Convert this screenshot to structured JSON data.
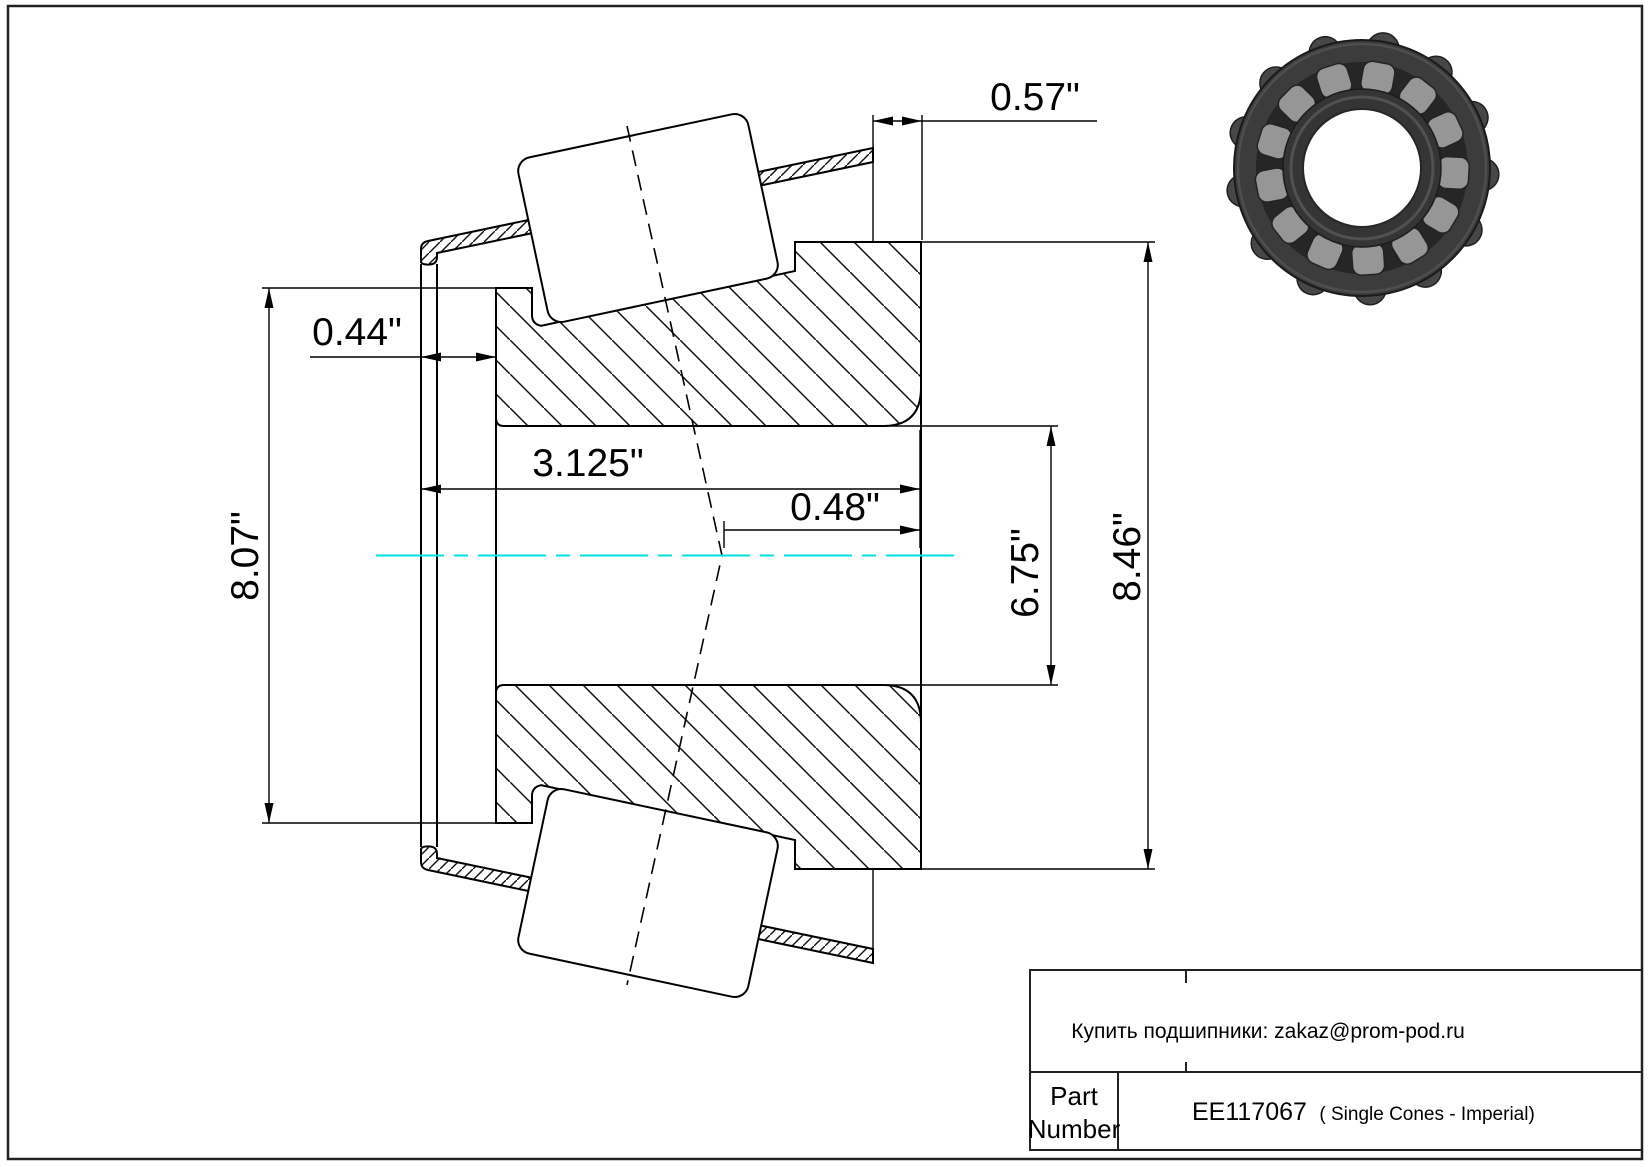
{
  "page": {
    "background": "#ffffff",
    "line_color": "#000000",
    "centerline_color": "#00e0e0",
    "bearing_photo_colors": {
      "body": "#3c3c3c",
      "rollers": "#969696",
      "inner_ring": "#353535",
      "outline": "#1a1a1a"
    }
  },
  "drawing": {
    "type": "tapered-roller-bearing-single-cone-section",
    "dimensions": {
      "back_face_to_cage": "0.57\"",
      "cage_to_front_face": "0.44\"",
      "cone_width": "3.125\"",
      "effective_center_offset": "0.48\"",
      "front_rib_diameter": "8.07\"",
      "bore_diameter": "6.75\"",
      "cage_outer_diameter": "8.46\""
    }
  },
  "title_block": {
    "contact": "Купить подшипники: zakaz@prom-pod.ru",
    "part_label_line1": "Part",
    "part_label_line2": "Number",
    "part_number": "EE117067",
    "part_type": "( Single Cones - Imperial)"
  }
}
